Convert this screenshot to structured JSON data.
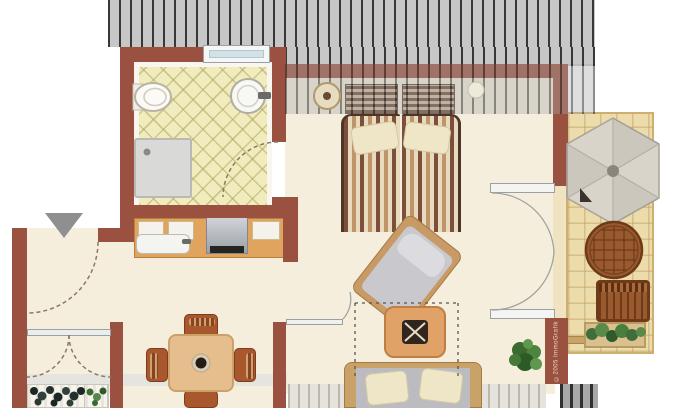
{
  "meta": {
    "title": "apartment-floor-plan",
    "watermark": "©2005 ImmoGrafik",
    "style": "furnished top-down architectural plan with roof hatching"
  },
  "palette": {
    "wall": "#9b5140",
    "floor_cream": "#f5eedd",
    "bath_tile": "#f1ecbd",
    "balcony_tile": "#eddcab",
    "roof_hatch": "#c7c7c7",
    "roof_line": "#383838",
    "counter_tan": "#e0a45f",
    "furniture_wood": "#c9a26a",
    "chair_brown": "#a9572c",
    "plant_green": "#4a7e3c",
    "arrow_gray": "#8f8f8f"
  },
  "rooms": {
    "bathroom": {
      "items": [
        "window",
        "toilet",
        "round-basin",
        "shower",
        "door-swing"
      ]
    },
    "kitchenette": {
      "items": [
        "sink-unit",
        "stove",
        "cabinets"
      ]
    },
    "bedroom": {
      "items": [
        "double-bed",
        "striped-duvet",
        "pillows",
        "headboard-cushions",
        "wall-decor",
        "roof-slope-hatch"
      ]
    },
    "living-room": {
      "items": [
        "armchair",
        "coffee-table",
        "sofa",
        "plant",
        "ceiling-height-dashed-line",
        "balcony-french-doors"
      ]
    },
    "dining-hall": {
      "items": [
        "dining-table",
        "four-chairs",
        "entry-arrow",
        "entry-door-swing",
        "french-window",
        "flower-boxes"
      ]
    },
    "balcony": {
      "items": [
        "parasol",
        "round-wicker-table",
        "bench",
        "planter-box",
        "railing"
      ]
    }
  }
}
